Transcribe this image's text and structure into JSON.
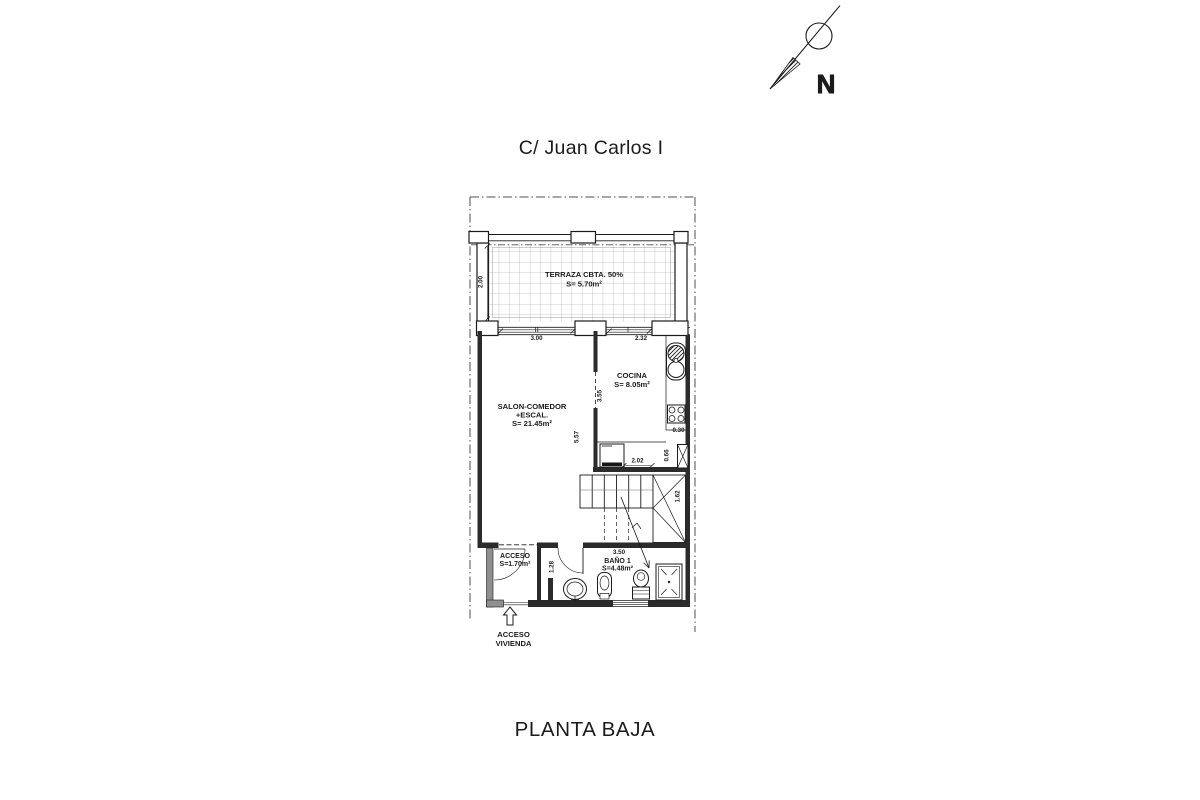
{
  "title": {
    "street": "C/ Juan Carlos I",
    "plan": "PLANTA BAJA"
  },
  "north": {
    "letter": "N"
  },
  "rooms": {
    "terraza": {
      "name": "TERRAZA CBTA. 50%",
      "area": "S= 5.70m²"
    },
    "salon": {
      "name": "SALON-COMEDOR",
      "name2": "+ESCAL.",
      "area": "S= 21.45m²"
    },
    "cocina": {
      "name": "COCINA",
      "area": "S= 8.05m²"
    },
    "acceso": {
      "name": "ACCESO",
      "area": "S=1.70m²"
    },
    "bano": {
      "name": "BAÑO 1",
      "area": "S=4.48m²"
    },
    "entrada": {
      "line1": "ACCESO",
      "line2": "VIVIENDA"
    }
  },
  "dims": {
    "terraza_depth": "2.00",
    "salon_window": "3.00",
    "cocina_window": "2.32",
    "cocina_depth": "3.55",
    "salon_depth": "5.57",
    "counter_width": "0.30",
    "shaft_height": "0.66",
    "cocina_width": "2.02",
    "stair_winder": "1.62",
    "bath_length": "3.50",
    "bath_width": "1.28"
  },
  "colors": {
    "line": "#1b1b1b",
    "wall": "#2b2b2b",
    "grid": "#9a9a9a",
    "boundary": "#4f4f4f"
  }
}
